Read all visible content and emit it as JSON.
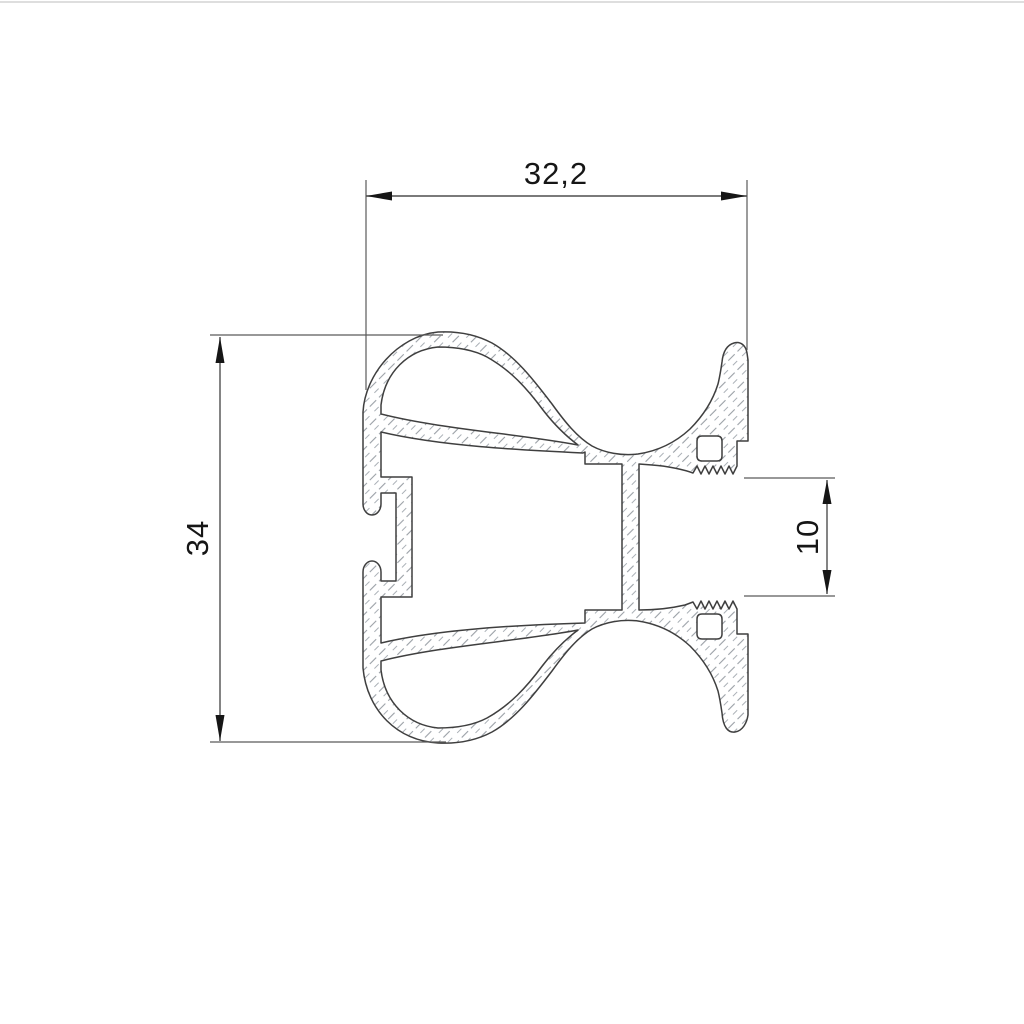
{
  "drawing": {
    "type": "technical-cross-section-profile",
    "dimensions": {
      "top_width": "32,2",
      "left_height": "34",
      "right_gap": "10"
    },
    "colors": {
      "background": "#ffffff",
      "profile_outline": "#3f3f3f",
      "dimension_lines": "#4f4f4f",
      "dimension_text": "#161616",
      "hatch": "#9aa0a6"
    }
  }
}
